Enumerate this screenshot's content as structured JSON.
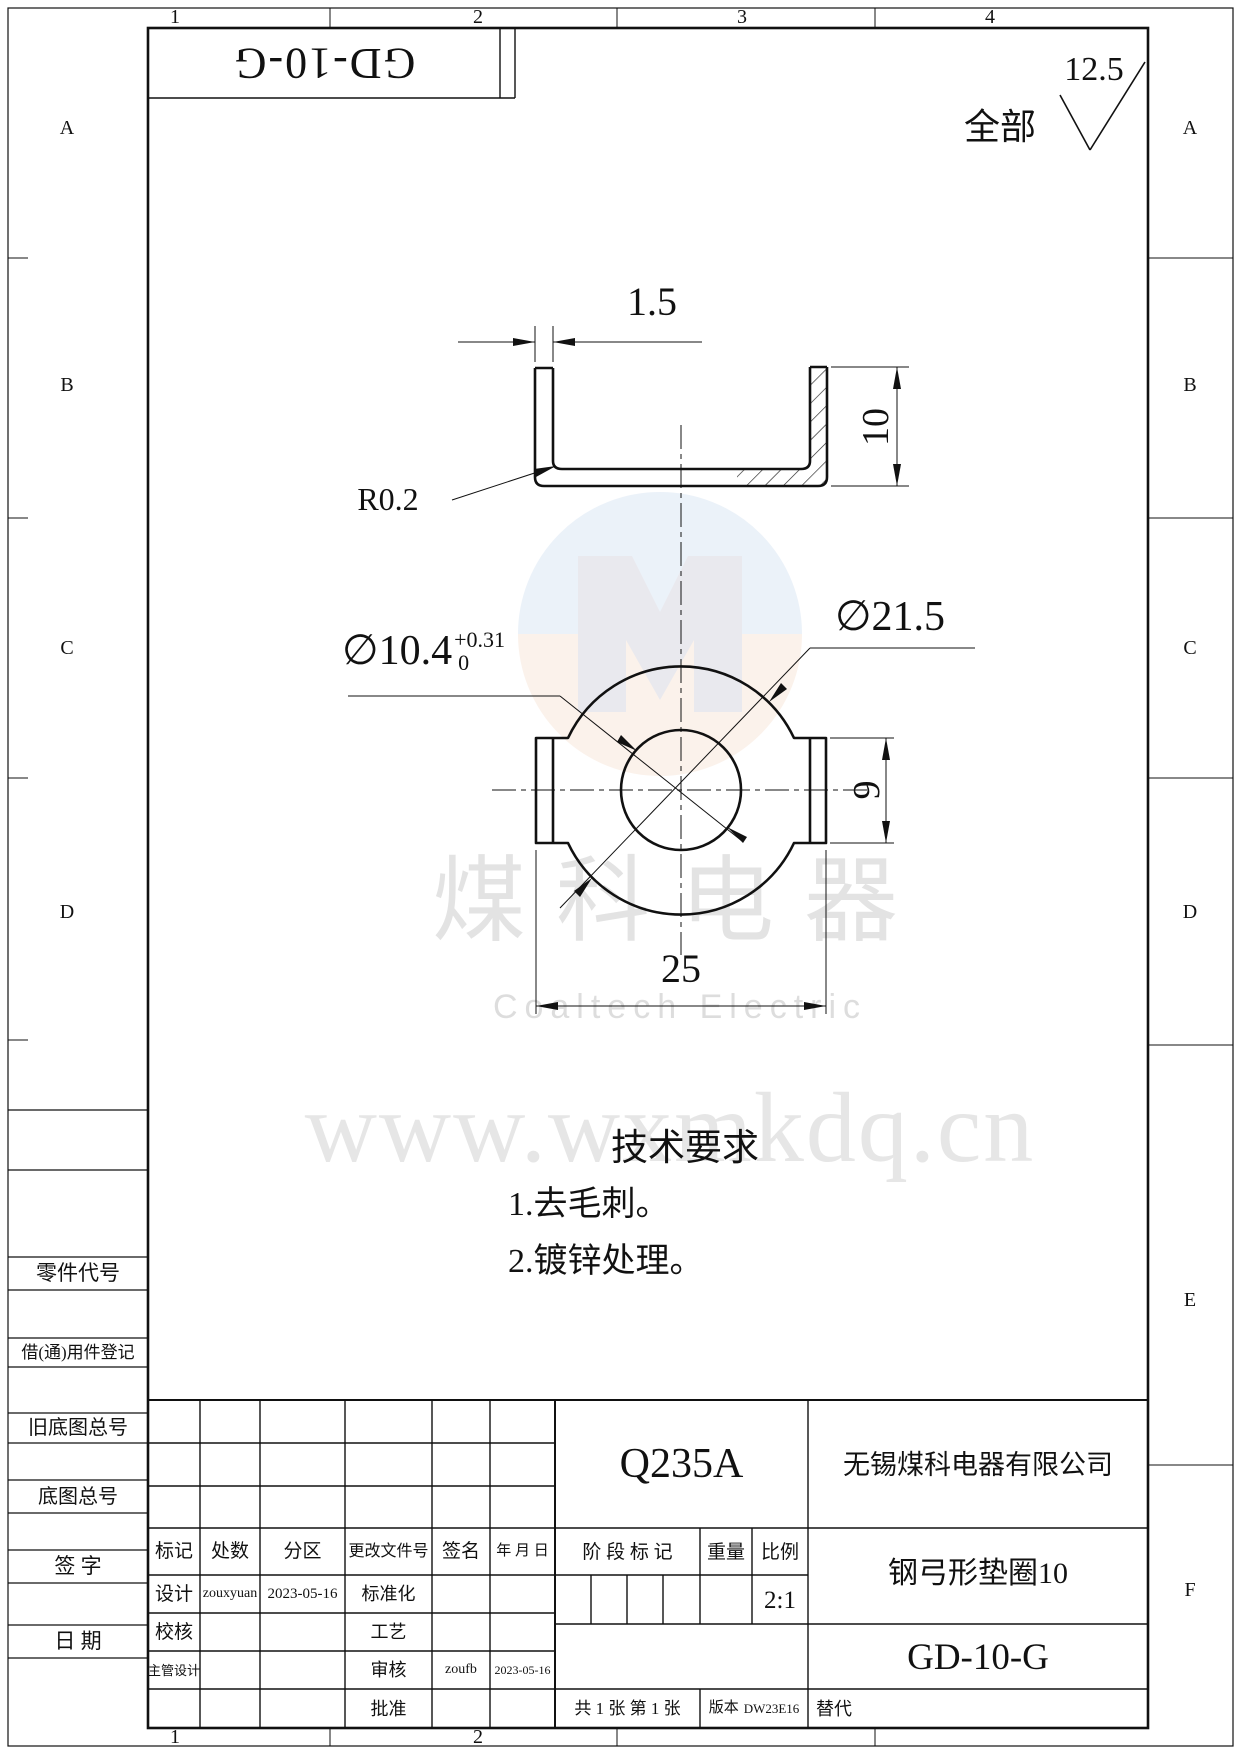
{
  "frame": {
    "zones_top": [
      "1",
      "2",
      "3",
      "4"
    ],
    "zones_bottom": [
      "1",
      "2"
    ],
    "zones_left": [
      "A",
      "B",
      "C",
      "D"
    ],
    "zones_right": [
      "A",
      "B",
      "C",
      "D",
      "E",
      "F"
    ]
  },
  "header": {
    "part_no_rotated": "GD-10-G",
    "finish_scope": "全部",
    "finish_value": "12.5"
  },
  "dims": {
    "thickness": "1.5",
    "height": "10",
    "radius": "R0.2",
    "hole": "∅10.4",
    "hole_tol_up": "+0.31",
    "hole_tol_low": "0",
    "outer": "∅21.5",
    "tab": "9",
    "width": "25"
  },
  "tech": {
    "title": "技术要求",
    "item1": "1.去毛刺。",
    "item2": "2.镀锌处理。"
  },
  "watermark": {
    "cn": "煤科电器",
    "en": "Coaltech Electric",
    "url": "www.wxmkdq.cn"
  },
  "side": {
    "part_code": "零件代号",
    "borrow": "借(通)用件登记",
    "old_no": "旧底图总号",
    "base_no": "底图总号",
    "sign": "签 字",
    "date": "日 期"
  },
  "tb": {
    "material": "Q235A",
    "company": "无锡煤科电器有限公司",
    "mark": "标记",
    "count": "处数",
    "zone": "分区",
    "change_doc": "更改文件号",
    "signature": "签名",
    "ymd": "年 月 日",
    "stage": "阶 段 标 记",
    "weight": "重量",
    "scale": "比例",
    "scale_value": "2:1",
    "design": "设计",
    "designer": "zouxyuan",
    "design_date": "2023-05-16",
    "standard": "标准化",
    "check": "校核",
    "process": "工艺",
    "chief": "主管设计",
    "audit": "审核",
    "auditor": "zoufb",
    "audit_date": "2023-05-16",
    "approve": "批准",
    "part_name": "钢弓形垫圈10",
    "drawing_no": "GD-10-G",
    "sheets": "共 1 张 第 1 张",
    "version_label": "版本",
    "version": "DW23E16",
    "replace": "替代"
  }
}
